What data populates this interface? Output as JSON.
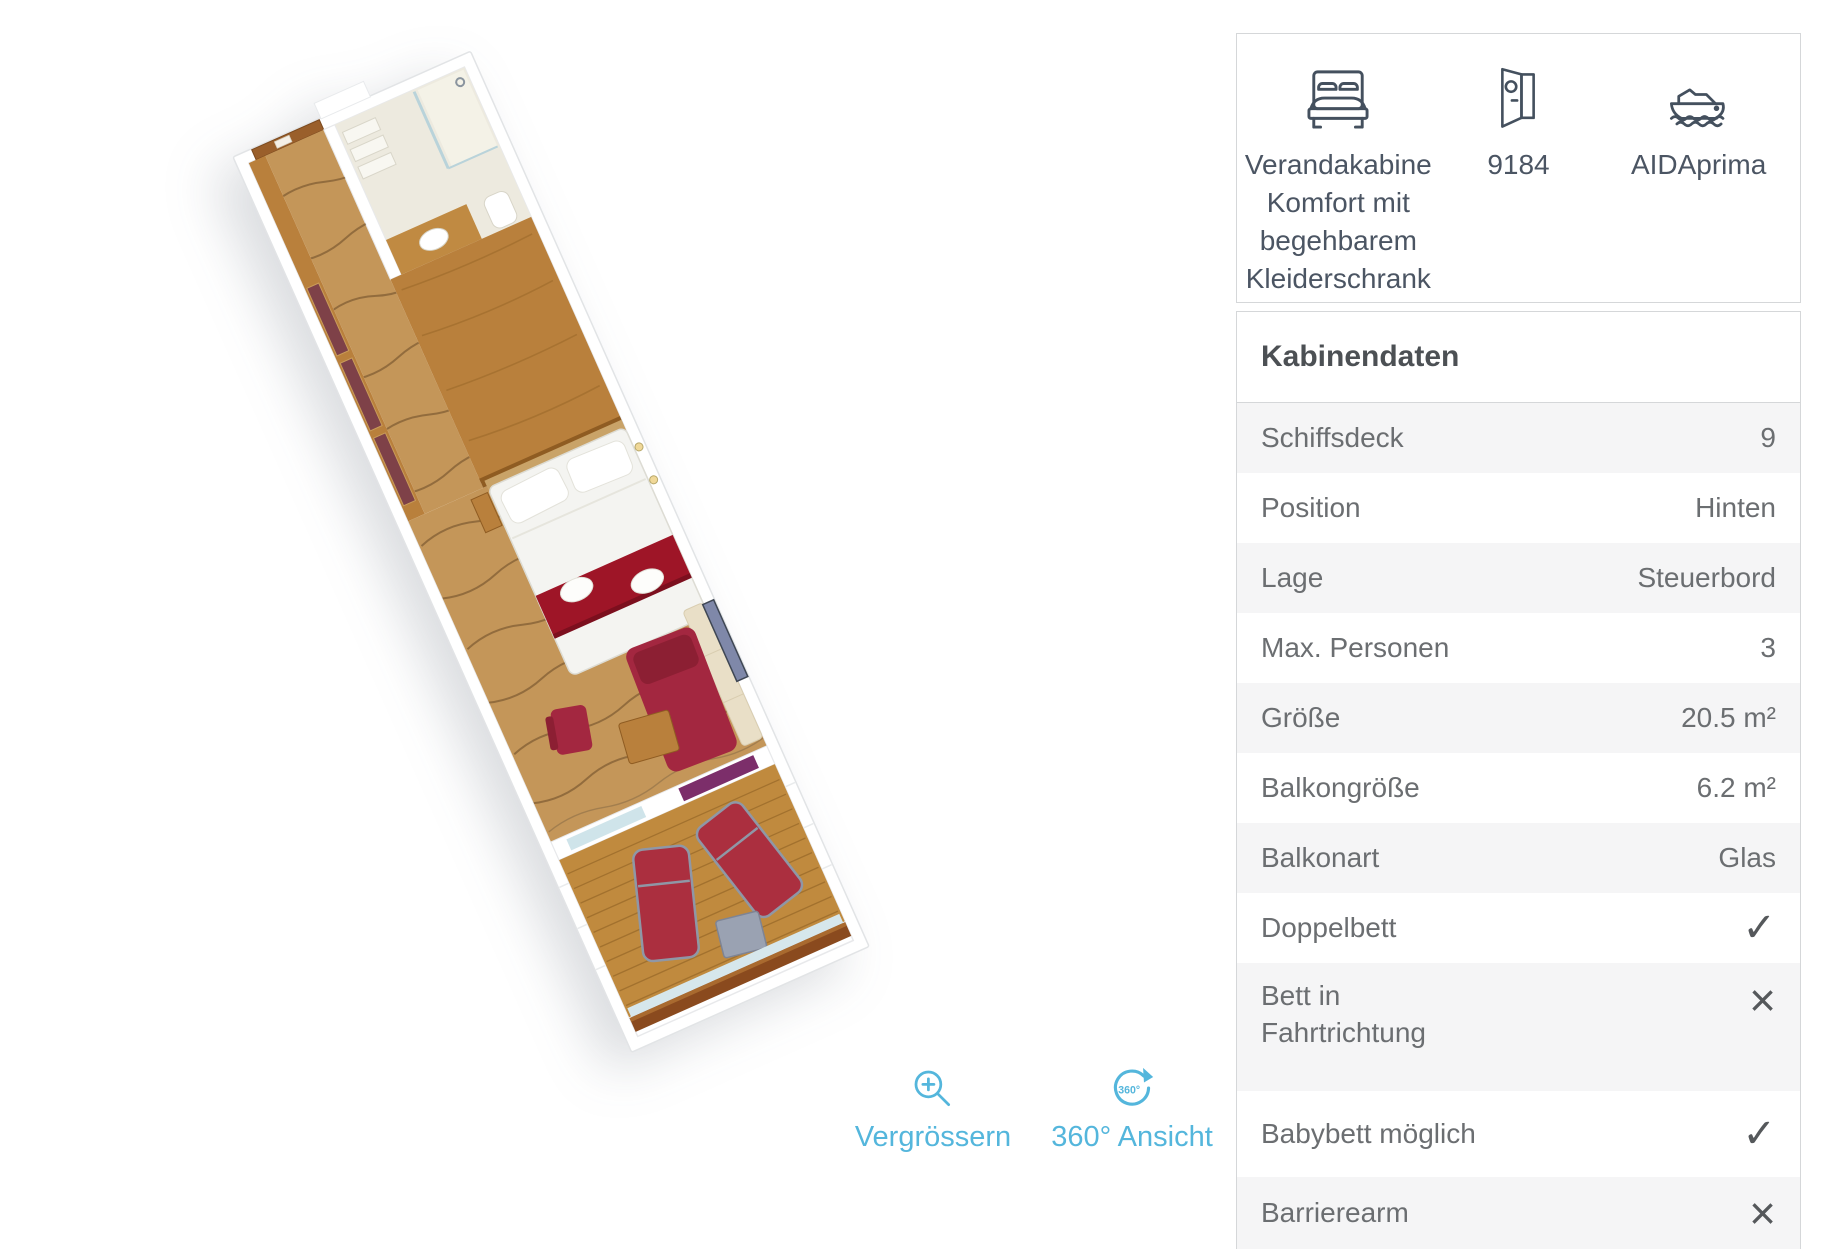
{
  "palette": {
    "accent": "#54b6dc",
    "icon": "#44505e",
    "heading_text": "#4c5054",
    "row_text": "#6b6e71",
    "caption_text": "#4b5563",
    "row_alt_bg": "#f5f5f6",
    "card_border": "#d5d7d9"
  },
  "floorplan_palette": {
    "carpet": "#c49659",
    "carpet_stroke": "#7e5b33",
    "wood": "#b9803c",
    "bed_runner_red": "#9e1527",
    "sofa_red": "#a32740",
    "lounger_red": "#ab2f3f",
    "balcony_deck": "#c08a3e",
    "wardrobe_maroon": "#7e4148",
    "accent_purple": "#7c2e6a",
    "rail_wood": "#8a4a1e"
  },
  "summary": {
    "items": [
      {
        "icon": "double-bed-icon",
        "label": "Verandakabine Komfort mit begehbarem Kleiderschrank"
      },
      {
        "icon": "cabin-door-icon",
        "label": "9184"
      },
      {
        "icon": "cruise-ship-icon",
        "label": "AIDAprima"
      }
    ]
  },
  "section": {
    "title": "Kabinendaten"
  },
  "table": {
    "rows": [
      {
        "label": "Schiffsdeck",
        "value": "9"
      },
      {
        "label": "Position",
        "value": "Hinten"
      },
      {
        "label": "Lage",
        "value": "Steuerbord"
      },
      {
        "label": "Max. Personen",
        "value": "3"
      },
      {
        "label": "Größe",
        "value": "20.5 m²"
      },
      {
        "label": "Balkongröße",
        "value": "6.2 m²"
      },
      {
        "label": "Balkonart",
        "value": "Glas"
      },
      {
        "label": "Doppelbett",
        "value": "✓"
      },
      {
        "label": "Bett in Fahrtrichtung",
        "value": "×"
      },
      {
        "label": "Babybett möglich",
        "value": "✓"
      },
      {
        "label": "Barrierearm",
        "value": "×"
      }
    ]
  },
  "controls": {
    "zoom_label": "Vergrössern",
    "rotate_label": "360° Ansicht",
    "badge": "360°"
  }
}
